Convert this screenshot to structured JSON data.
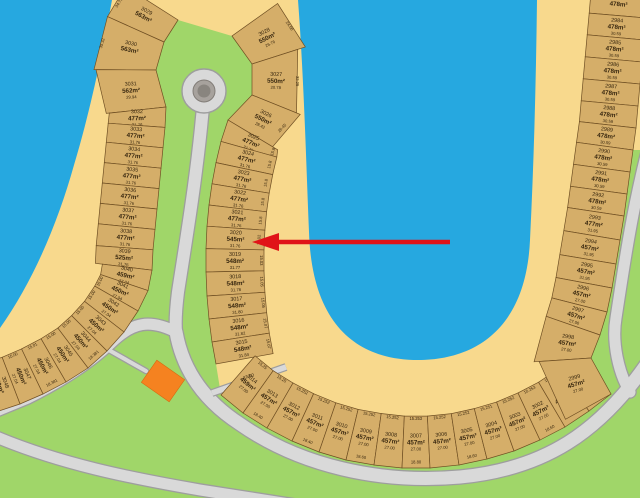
{
  "map": {
    "walkway_label": "37.00",
    "annotation_arrow": {
      "color": "#e01318",
      "points_at_lot": "3020"
    },
    "colors": {
      "water": "#26a8e0",
      "sand": "#f8d98d",
      "grass": "#a0d669",
      "road": "#d9d9d9",
      "road_border": "#9e9e9e",
      "lot_fill": "#d5ae69",
      "lot_border": "#6f4f23",
      "lot_text": "#38270f",
      "building": "#f58220",
      "island": "#a7a29d",
      "island_core": "#89857f"
    },
    "strips": [
      {
        "id": "west",
        "lots": [
          {
            "id": "3029",
            "area": "563m²",
            "front": "34.75"
          },
          {
            "id": "3030",
            "area": "563m²",
            "front": "35.32"
          },
          {
            "id": "3031",
            "area": "562m²",
            "dim": "29.94"
          },
          {
            "id": "3032",
            "area": "477m²",
            "dim": "31.76"
          },
          {
            "id": "3033",
            "area": "477m²",
            "dim": "31.76"
          },
          {
            "id": "3034",
            "area": "477m²",
            "dim": "31.76"
          },
          {
            "id": "3035",
            "area": "477m²",
            "dim": "31.76"
          },
          {
            "id": "3036",
            "area": "477m²",
            "dim": "31.76"
          },
          {
            "id": "3037",
            "area": "477m²",
            "dim": "31.76"
          },
          {
            "id": "3038",
            "area": "477m²",
            "dim": "31.76"
          },
          {
            "id": "3039",
            "area": "525m²",
            "dim": "31.76"
          },
          {
            "id": "3040",
            "area": "459m²",
            "dim": "27.04"
          },
          {
            "id": "3041",
            "area": "450m²",
            "dim": "27.04",
            "front": "15.00"
          },
          {
            "id": "3042",
            "area": "450m²",
            "dim": "27.04",
            "front": "15.00"
          },
          {
            "id": "3043",
            "area": "450m²",
            "dim": "27.04",
            "front": "15.00"
          },
          {
            "id": "3044",
            "area": "450m²",
            "dim": "27.04",
            "front": "15.00",
            "back": "18.381"
          },
          {
            "id": "3045",
            "area": "450m²",
            "dim": "27.04",
            "front": "15.00"
          },
          {
            "id": "3046",
            "area": "450m²",
            "dim": "27.04",
            "front": "15.01",
            "back": "18.381"
          },
          {
            "id": "3047",
            "area": "450m²",
            "dim": "27.04",
            "front": "15.00"
          },
          {
            "id": "3048",
            "area": "450m²",
            "dim": "27.04",
            "front": "15.00"
          }
        ]
      },
      {
        "id": "inner-west",
        "lots": [
          {
            "id": "3028",
            "area": "550m²",
            "dim": "26.76",
            "front": "24.60"
          },
          {
            "id": "3027",
            "area": "550m²",
            "dim": "20.78",
            "front": "32.25"
          },
          {
            "id": "3026",
            "area": "550m²",
            "dim": "28.42",
            "front": "26.45"
          },
          {
            "id": "3025",
            "area": "477m²",
            "dim": "31.76",
            "front": "15.8"
          },
          {
            "id": "3024",
            "area": "477m²",
            "dim": "31.76",
            "front": "15.8"
          },
          {
            "id": "3023",
            "area": "477m²",
            "dim": "31.76",
            "front": "15.8"
          },
          {
            "id": "3022",
            "area": "477m²",
            "dim": "31.76",
            "front": "15.8"
          },
          {
            "id": "3021",
            "area": "477m²",
            "dim": "31.76",
            "front": "15.8"
          },
          {
            "id": "3020",
            "area": "545m²",
            "dim": "31.76",
            "front": "15.02"
          },
          {
            "id": "3019",
            "area": "548m²",
            "dim": "31.77",
            "front": "15.03"
          },
          {
            "id": "3018",
            "area": "548m²",
            "dim": "31.78",
            "front": "15.05"
          },
          {
            "id": "3017",
            "area": "548m²",
            "dim": "31.80",
            "front": "15.05"
          },
          {
            "id": "3016",
            "area": "548m²",
            "dim": "31.82",
            "front": "15.07"
          },
          {
            "id": "3015",
            "area": "548m²",
            "dim": "31.84",
            "front": "15.07"
          }
        ]
      },
      {
        "id": "south",
        "lots": [
          {
            "id": "3014",
            "area": "459m²",
            "dim": "27.00",
            "front": "15.25"
          },
          {
            "id": "3013",
            "area": "457m²",
            "dim": "27.00",
            "front": "15.25",
            "back": "18.40"
          },
          {
            "id": "3012",
            "area": "457m²",
            "dim": "27.00",
            "front": "15.252"
          },
          {
            "id": "3011",
            "area": "457m²",
            "dim": "27.00",
            "front": "15.252",
            "back": "18.40"
          },
          {
            "id": "3010",
            "area": "457m²",
            "dim": "27.00",
            "front": "15.252"
          },
          {
            "id": "3009",
            "area": "457m²",
            "dim": "27.00",
            "front": "15.252",
            "back": "18.60"
          },
          {
            "id": "3008",
            "area": "457m²",
            "dim": "27.00",
            "front": "15.252"
          },
          {
            "id": "3007",
            "area": "457m²",
            "dim": "27.00",
            "front": "15.253",
            "back": "18.80"
          },
          {
            "id": "3006",
            "area": "457m²",
            "dim": "27.00",
            "front": "15.252"
          },
          {
            "id": "3005",
            "area": "457m²",
            "dim": "27.00",
            "front": "15.252",
            "back": "18.60"
          },
          {
            "id": "3004",
            "area": "457m²",
            "dim": "27.00",
            "front": "15.251"
          },
          {
            "id": "3003",
            "area": "457m²",
            "dim": "27.00",
            "front": "15.252"
          },
          {
            "id": "3002",
            "area": "457m²",
            "dim": "27.00",
            "front": "15.253",
            "back": "18.60"
          },
          {
            "id": "3001",
            "area": "457m²",
            "dim": "27.00",
            "front": "15.252"
          },
          {
            "id": "3000",
            "area": "457m²",
            "dim": "27.00",
            "front": "15.252"
          }
        ]
      },
      {
        "id": "east",
        "lots": [
          {
            "id": "2983",
            "area": "478m²"
          },
          {
            "id": "2984",
            "area": "478m²",
            "dim": "30.59"
          },
          {
            "id": "2985",
            "area": "478m²",
            "dim": "30.59"
          },
          {
            "id": "2986",
            "area": "478m²",
            "dim": "30.59"
          },
          {
            "id": "2987",
            "area": "478m²",
            "dim": "30.59"
          },
          {
            "id": "2988",
            "area": "478m²",
            "dim": "30.59"
          },
          {
            "id": "2989",
            "area": "478m²",
            "dim": "30.59"
          },
          {
            "id": "2990",
            "area": "478m²",
            "dim": "30.59"
          },
          {
            "id": "2991",
            "area": "478m²",
            "dim": "30.59"
          },
          {
            "id": "2992",
            "area": "478m²",
            "dim": "30.59"
          },
          {
            "id": "2993",
            "area": "477m²",
            "dim": "31.95"
          },
          {
            "id": "2994",
            "area": "457m²",
            "dim": "31.95"
          },
          {
            "id": "2995",
            "area": "457m²",
            "dim": "31.95"
          },
          {
            "id": "2996",
            "area": "457m²",
            "dim": "27.00"
          },
          {
            "id": "2997",
            "area": "457m²",
            "dim": "27.00"
          },
          {
            "id": "2998",
            "area": "457m²",
            "dim": "27.00"
          },
          {
            "id": "2999",
            "area": "457m²",
            "dim": "27.00"
          }
        ]
      }
    ]
  }
}
